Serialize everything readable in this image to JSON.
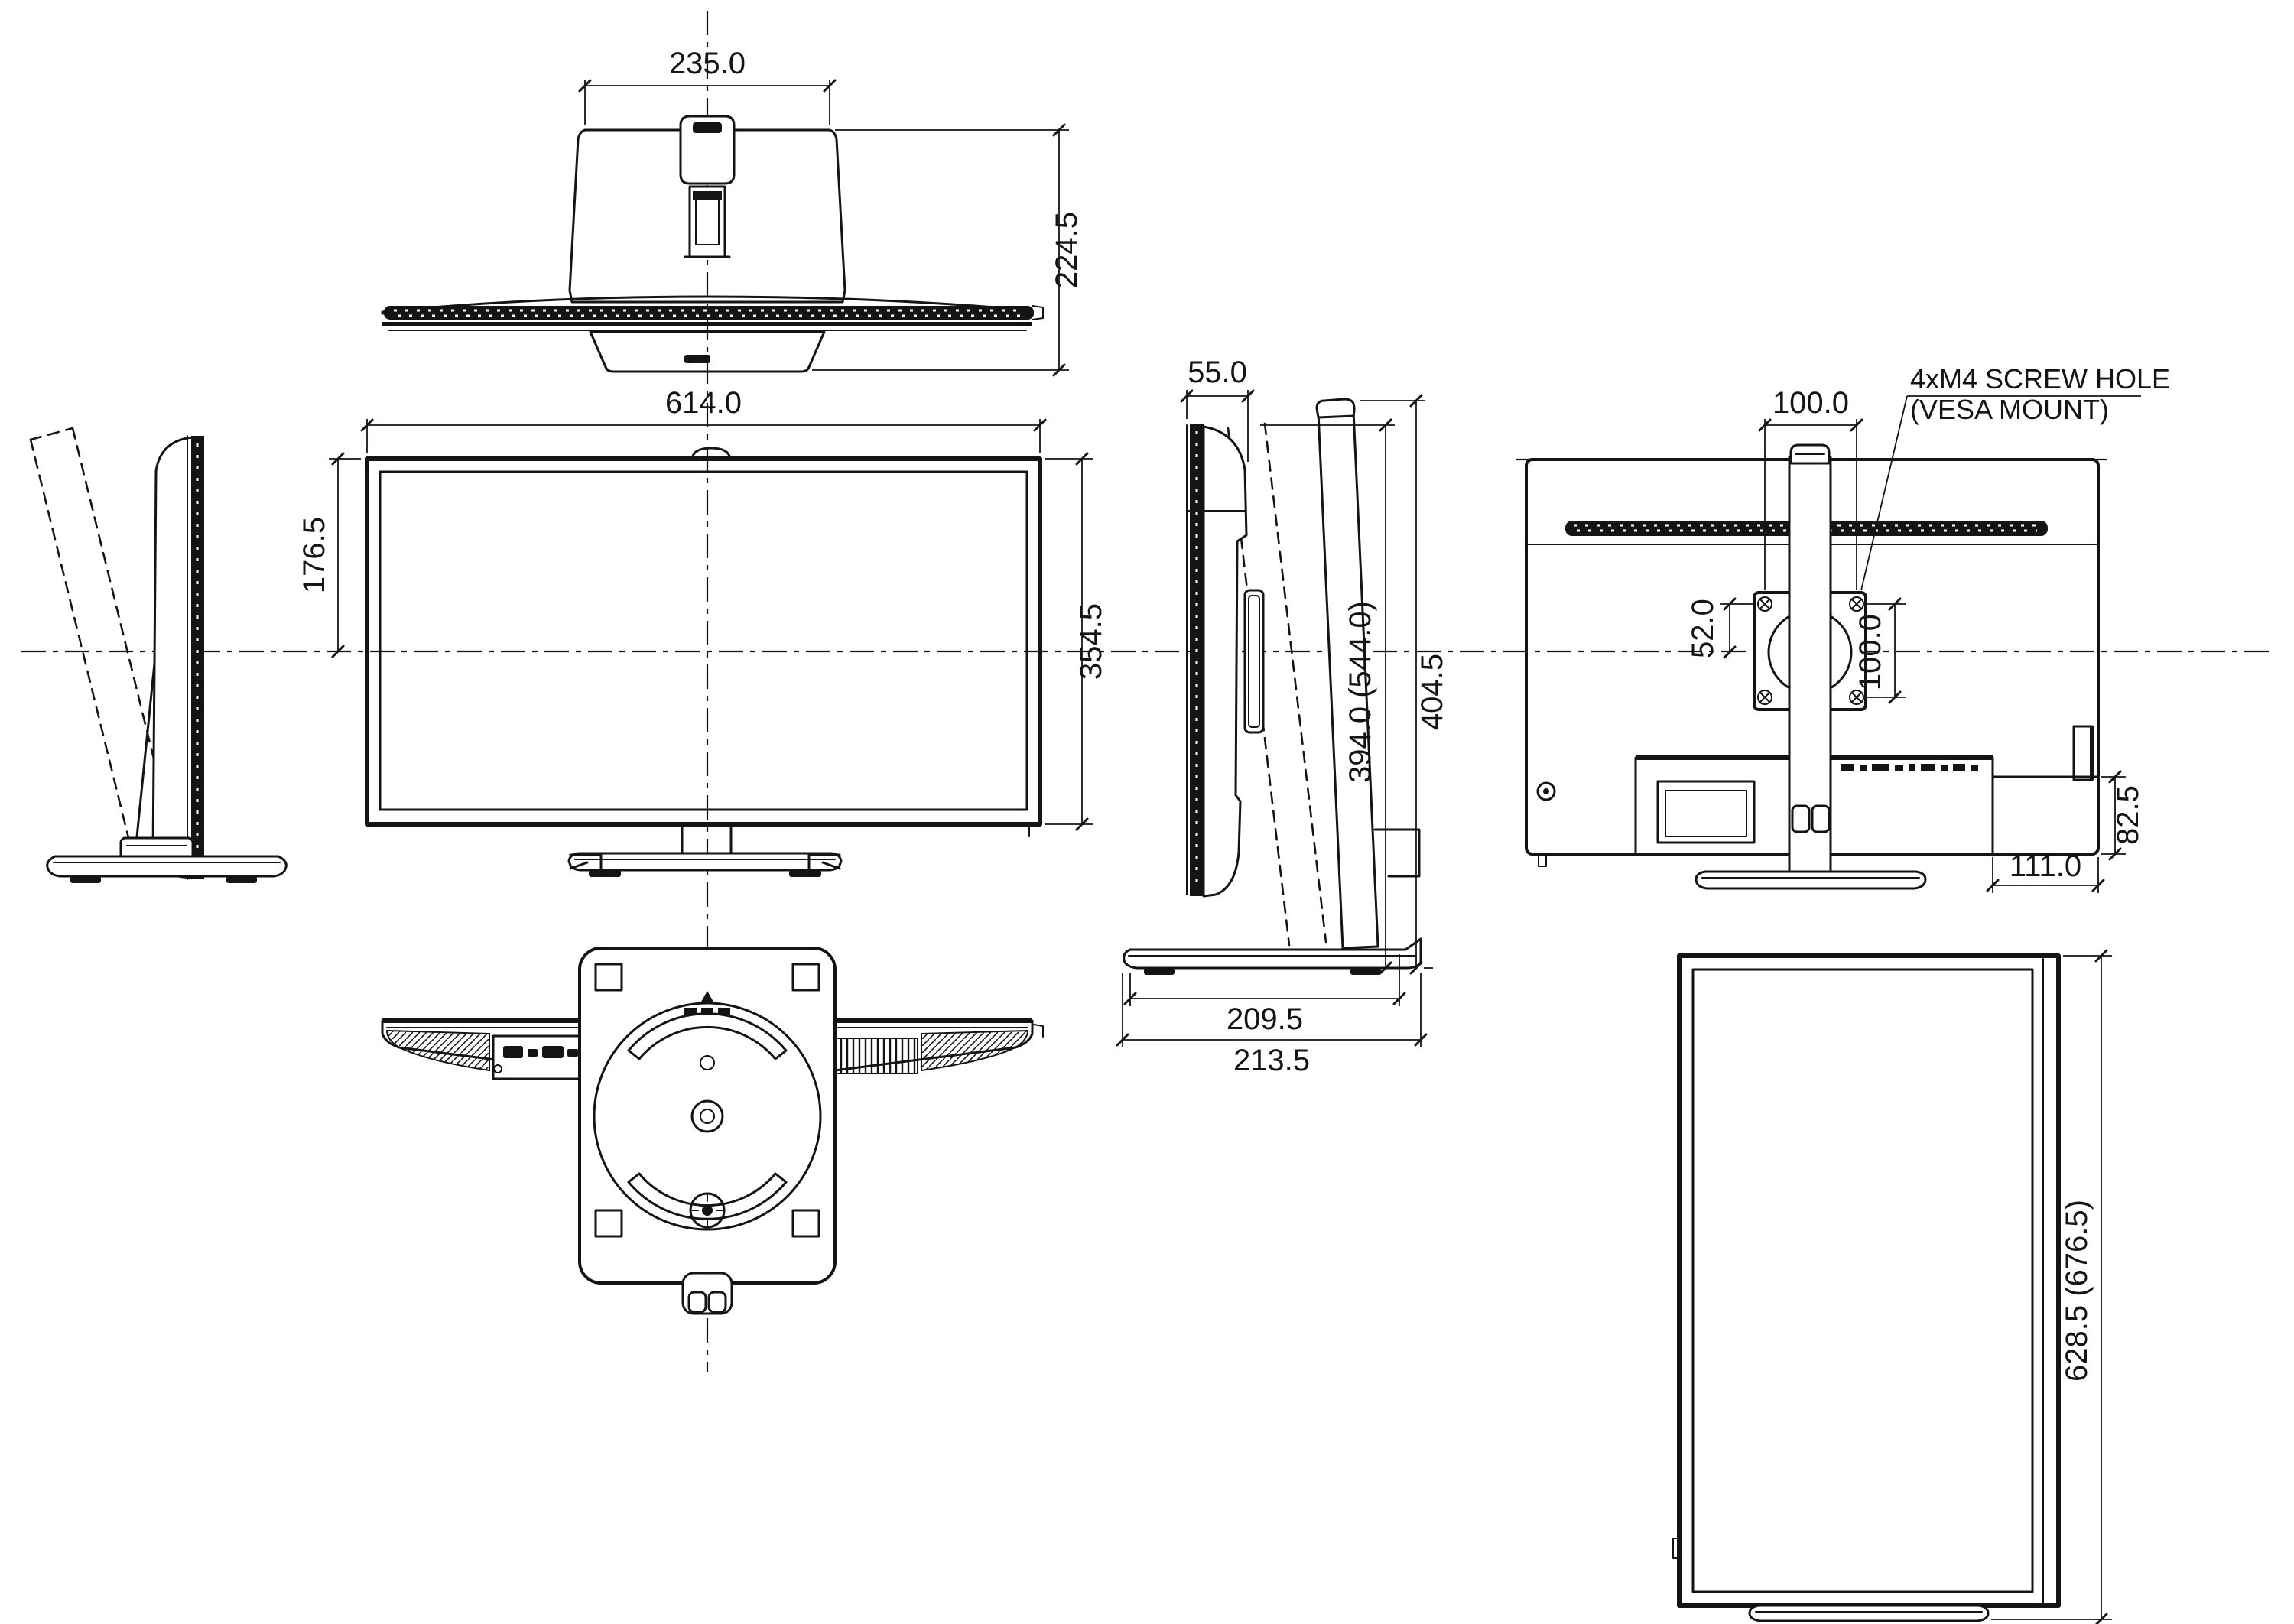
{
  "drawing": {
    "background": "#ffffff",
    "line_color": "#141414",
    "views": {
      "top": {
        "base_width": "235.0",
        "depth": "224.5"
      },
      "front": {
        "width": "614.0",
        "upper_height": "176.5",
        "height": "354.5"
      },
      "side": {
        "depth": "55.0",
        "height_min_max": "394.0 (544.0)",
        "total_height": "404.5",
        "base_depth_inner": "209.5",
        "base_depth": "213.5"
      },
      "rear": {
        "vesa_width": "100.0",
        "vesa_top_offset": "52.0",
        "vesa_height": "100.0",
        "note_line1": "4xM4 SCREW HOLE",
        "note_line2": "(VESA MOUNT)",
        "corner_box_height": "82.5",
        "corner_box_width": "111.0"
      },
      "portrait": {
        "total_height": "628.5 (676.5)"
      }
    }
  }
}
